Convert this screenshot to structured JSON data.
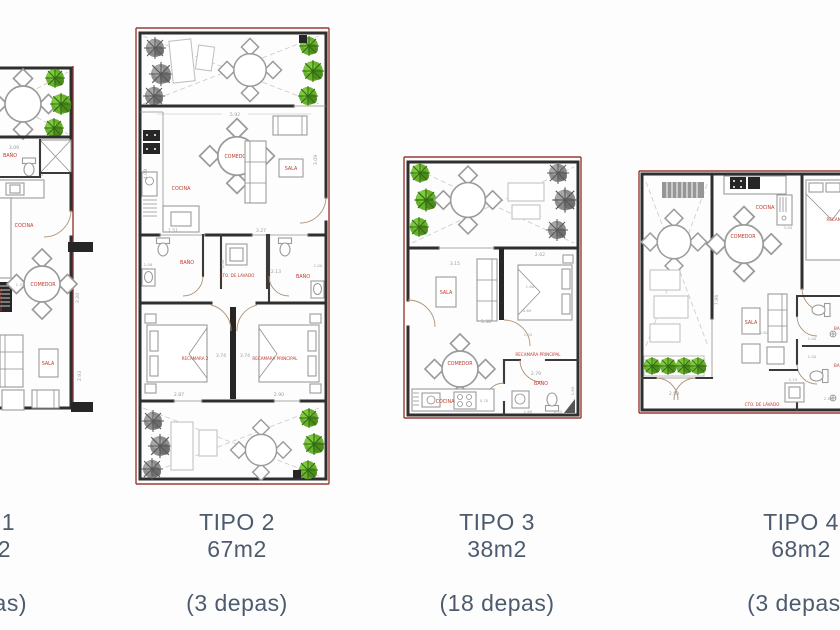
{
  "page": {
    "background": "#fdfdfe",
    "caption_color": "#4d5b6e",
    "room_label_color": "#c0392b",
    "dimension_color": "#9b9b9b",
    "wall_color": "#2f2f2f",
    "plan_edge_red": "#9c3a32",
    "plant_green": "#69b02c",
    "plant_gray": "#8d8d8d"
  },
  "plans": [
    {
      "title": "1",
      "area": "2",
      "depas": "as)",
      "rooms": {
        "bano": "BAÑO",
        "cocina": "COCINA",
        "comedor": "COMEDOR",
        "sala": "SALA",
        "partial": "RECAMARA"
      },
      "dims": [
        "3.09",
        "1.97",
        "1.50",
        "1.35",
        "3.20",
        "2.93"
      ]
    },
    {
      "title": "TIPO 2",
      "area": "67m2",
      "depas": "(3 depas)",
      "rooms": {
        "comedor": "COMEDOR",
        "cocina": "COCINA",
        "sala": "SALA",
        "bano1": "BAÑO",
        "lavado": "CTO. DE LAVADO",
        "bano2": "BAÑO",
        "recamara2": "RECAMARA 2",
        "recamara_principal": "RECAMARA PRINCIPAL"
      },
      "dims": [
        "5.92",
        "4.09",
        "3.09",
        "1.51",
        "3.27",
        "1.06",
        "0.98",
        "2.13",
        "1.00",
        "3.74",
        "3.74",
        "2.87",
        "2.90"
      ]
    },
    {
      "title": "TIPO 3",
      "area": "38m2",
      "depas": "(18 depas)",
      "rooms": {
        "sala": "SALA",
        "comedor": "COMEDOR",
        "cocina": "COCINA",
        "recamara_principal": "RECAMARA PRINCIPAL",
        "bano": "BAÑO"
      },
      "dims": [
        "3.15",
        "2.62",
        "1.80",
        "0.69",
        "5.38",
        "1.05",
        "2.79",
        "1.60",
        "0.70",
        "1.60",
        "0.45"
      ]
    },
    {
      "title": "TIPO 4",
      "area": "68m2",
      "depas": "(3 depas)",
      "rooms": {
        "cocina": "COCINA",
        "comedor": "COMEDOR",
        "recamara": "RECAMARA",
        "sala": "SALA",
        "bano1": "BAÑO",
        "bano2": "BAÑO",
        "lavado": "CTO. DE LAVADO"
      },
      "dims": [
        "7.96",
        "2.58",
        "3.05",
        "2.89",
        "2.62",
        "1.00",
        "1.00",
        "1.15",
        "2.13"
      ]
    }
  ]
}
